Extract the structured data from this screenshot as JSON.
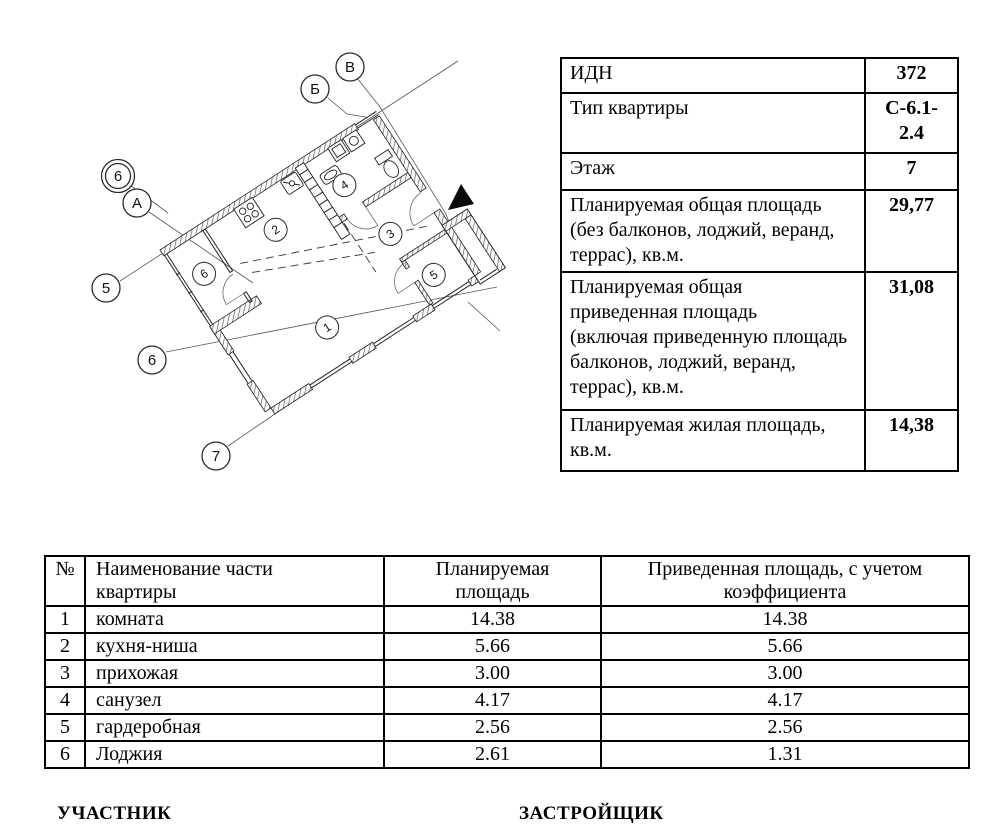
{
  "floor_plan": {
    "axis_labels": {
      "v": "В",
      "b": "Б",
      "d6": "6",
      "a": "А",
      "n5": "5",
      "n6": "6",
      "n7": "7"
    },
    "room_labels": {
      "r1": "1",
      "r2": "2",
      "r3": "3",
      "r4": "4",
      "r5": "5",
      "r6": "6"
    }
  },
  "info_table": {
    "rows": [
      {
        "label": "ИДН",
        "value": "372"
      },
      {
        "label": "Тип квартиры",
        "value": "С-6.1-\n2.4"
      },
      {
        "label": "Этаж",
        "value": "7"
      },
      {
        "label": "Планируемая общая площадь\n(без балконов, лоджий, веранд,\nтеррас), кв.м.",
        "value": "29,77"
      },
      {
        "label": "Планируемая общая\nприведенная площадь\n(включая приведенную площадь\nбалконов, лоджий, веранд,\nтеррас), кв.м.",
        "value": "31,08"
      },
      {
        "label": "Планируемая жилая площадь,\nкв.м.",
        "value": "14,38"
      }
    ]
  },
  "rooms_table": {
    "headers": {
      "num": "№",
      "name": "Наименование части\nквартиры",
      "planned": "Планируемая\nплощадь",
      "reduced": "Приведенная площадь, с учетом\nкоэффициента"
    },
    "rows": [
      {
        "num": "1",
        "name": "комната",
        "planned": "14.38",
        "reduced": "14.38"
      },
      {
        "num": "2",
        "name": "кухня-ниша",
        "planned": "5.66",
        "reduced": "5.66"
      },
      {
        "num": "3",
        "name": "прихожая",
        "planned": "3.00",
        "reduced": "3.00"
      },
      {
        "num": "4",
        "name": "санузел",
        "planned": "4.17",
        "reduced": "4.17"
      },
      {
        "num": "5",
        "name": "гардеробная",
        "planned": "2.56",
        "reduced": "2.56"
      },
      {
        "num": "6",
        "name": "Лоджия",
        "planned": "2.61",
        "reduced": "1.31"
      }
    ]
  },
  "signatures": {
    "participant": "УЧАСТНИК",
    "developer": "ЗАСТРОЙЩИК"
  }
}
